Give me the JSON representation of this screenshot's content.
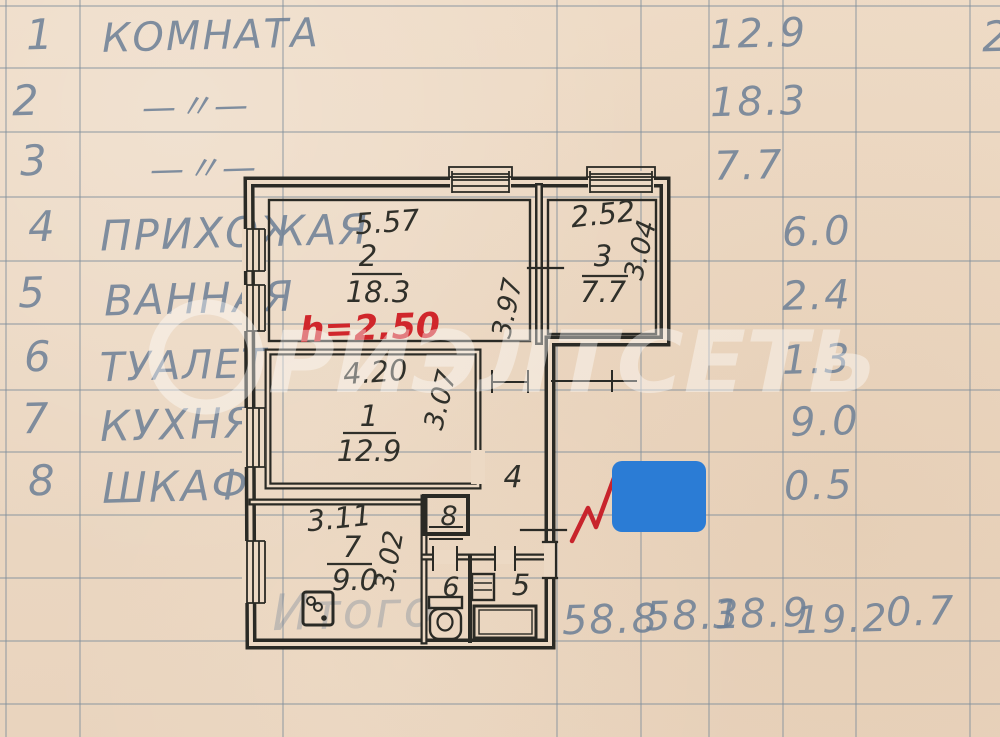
{
  "page": {
    "kind": "Scanned apartment ledger page with BTI floor plan"
  },
  "table": {
    "rows": [
      {
        "num": "1",
        "name": "КОМНАТА",
        "area": "12.9"
      },
      {
        "num": "2",
        "name": "—〃—",
        "area": "18.3"
      },
      {
        "num": "3",
        "name": "—〃—",
        "area": "7.7"
      },
      {
        "num": "4",
        "name": "ПРИХОЖАЯ",
        "area": "6.0"
      },
      {
        "num": "5",
        "name": "ВАННАЯ",
        "area": "2.4"
      },
      {
        "num": "6",
        "name": "ТУАЛЕТ",
        "area": "1.3"
      },
      {
        "num": "7",
        "name": "КУХНЯ",
        "area": "9.0"
      },
      {
        "num": "8",
        "name": "ШКАФ",
        "area": "0.5"
      }
    ],
    "totals_label": "Итого",
    "totals": [
      "58.8",
      "58.1",
      "38.9",
      "19.2",
      "0.7"
    ],
    "top_right_partial": "2"
  },
  "plan": {
    "height_note": "h=2.50",
    "rooms": {
      "room2": {
        "num": "2",
        "area": "18.3"
      },
      "room3": {
        "num": "3",
        "area": "7.7"
      },
      "room1": {
        "num": "1",
        "area": "12.9"
      },
      "room7": {
        "num": "7",
        "area": "9.0"
      },
      "room4_label": "4",
      "room5_label": "5",
      "room6_label": "6",
      "room8_label": "8"
    },
    "dims": {
      "room2_width": "5.57",
      "room3_width": "2.52",
      "room3_depth": "3.04",
      "corridor_len": "3.97",
      "room1_width": "4.20",
      "room1_depth": "3.07",
      "kitchen_width": "3.11",
      "kitchen_depth": "3.02"
    }
  },
  "watermark": {
    "text": "РИЭЛТСЕТЬ"
  },
  "colors": {
    "paper": "#ecd9c4",
    "ink": "#2a2a25",
    "pencil": "#6c7f96",
    "height_note": "#d0262b",
    "checkmark": "#c8242c",
    "redaction": "#2b7cd5"
  }
}
